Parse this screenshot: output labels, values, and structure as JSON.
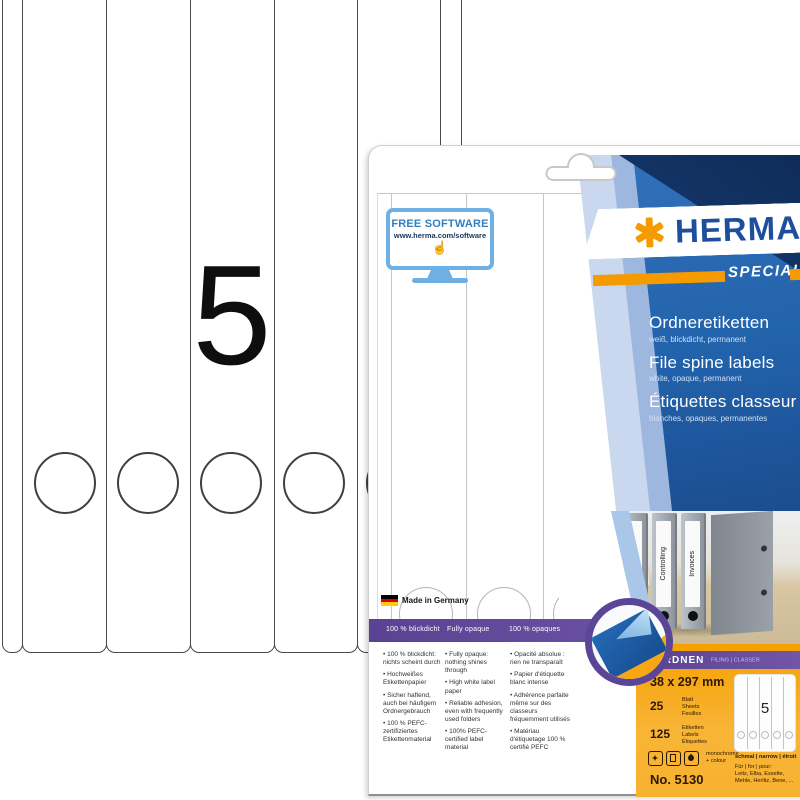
{
  "product": {
    "brand": "HERMA",
    "series": "SPECIAL",
    "category": {
      "main": "ORDNEN",
      "sub": "FILING | CLASSER"
    },
    "titles": [
      {
        "title": "Ordneretiketten",
        "subtitle": "weiß, blickdicht, permanent"
      },
      {
        "title": "File spine labels",
        "subtitle": "white, opaque, permanent"
      },
      {
        "title": "Étiquettes classeur",
        "subtitle": "blanches, opaques, permanentes"
      }
    ],
    "made_in": "Made in Germany"
  },
  "free_software": {
    "title": "FREE SOFTWARE",
    "url": "www.herma.com/software"
  },
  "sheet": {
    "digit": "5"
  },
  "binders": [
    "Marketing",
    "Controlling",
    "Invoices"
  ],
  "features": {
    "columns": [
      {
        "header": "100 % blickdicht",
        "items": [
          "100 % blickdicht: nichts scheint durch",
          "Hochweißes Etikettenpapier",
          "Sicher haftend, auch bei häufigem Ordnergebrauch",
          "100 % PEFC-zertifiziertes Etikettenmaterial"
        ]
      },
      {
        "header": "Fully opaque",
        "items": [
          "Fully opaque: nothing shines through",
          "High white label paper",
          "Reliable adhesion, even with frequently used folders",
          "100% PEFC-certified label material"
        ]
      },
      {
        "header": "100 % opaques",
        "items": [
          "Opacité absolue : rien ne transparaît",
          "Papier d'étiquette blanc intense",
          "Adhérence parfaite même sur des classeurs fréquemment utilisés",
          "Matériau d'étiquetage 100 % certifié PEFC"
        ]
      }
    ]
  },
  "specs": {
    "size": "38 x 297 mm",
    "sheets_value": "25",
    "sheets_units": [
      "Blatt",
      "Sheets",
      "Feuilles"
    ],
    "labels_value": "125",
    "labels_units": [
      "Etiketten",
      "Labels",
      "Étiquettes"
    ],
    "print_note": "monochrome + colour",
    "article_no": "No. 5130",
    "mini_digit": "5",
    "width_note": "schmal | narrow | étroit",
    "compat_intro": "Für | for | pour:",
    "compat_brands": "Leitz, Elba, Esselte, Mehle, Herlitz, Bene, ..."
  },
  "icons": {
    "hand_pointer_glyph": "☝"
  },
  "colors": {
    "herma_orange": "#f59b00",
    "herma_blue": "#1e4f9c",
    "panel_blue": "#2e6db6",
    "navy": "#16386b",
    "purple": "#5d4496",
    "orange_bg": "#f7a600"
  }
}
